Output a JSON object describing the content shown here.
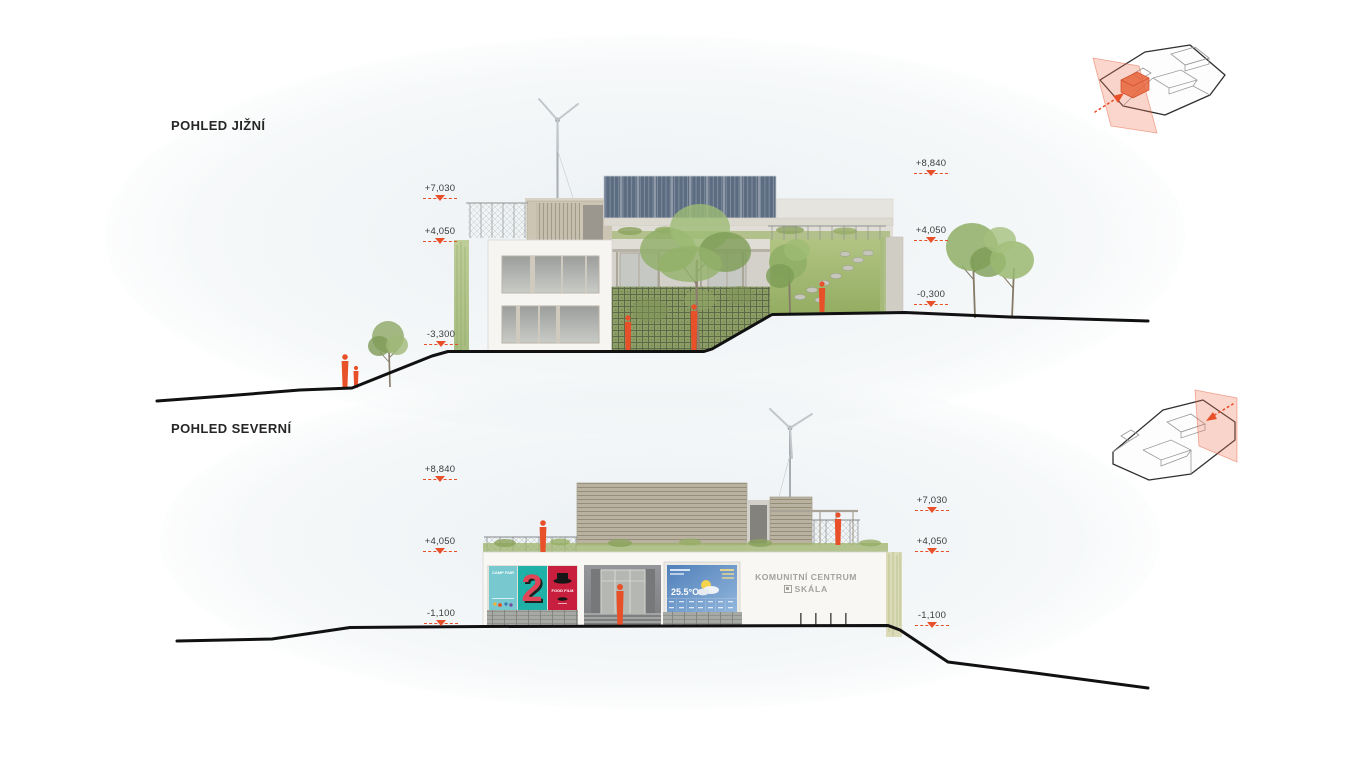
{
  "colors": {
    "accent_orange": "#E8502A",
    "terrain_line": "#111111",
    "title_text": "#262626",
    "marker_text": "#3C3C3C",
    "sign_text": "#A3A39E",
    "solar_panel": "#5D6C80",
    "trellis_green": "#8D9E66"
  },
  "south_elevation": {
    "title": "POHLED JIŽNÍ",
    "markers_left": [
      {
        "label": "+7,030"
      },
      {
        "label": "+4,050"
      },
      {
        "label": "-3,300"
      }
    ],
    "markers_right": [
      {
        "label": "+8,840"
      },
      {
        "label": "+4,050"
      },
      {
        "label": "-0,300"
      }
    ]
  },
  "north_elevation": {
    "title": "POHLED SEVERNÍ",
    "markers_left": [
      {
        "label": "+8,840"
      },
      {
        "label": "+4,050"
      },
      {
        "label": "-1,100"
      }
    ],
    "markers_right": [
      {
        "label": "+7,030"
      },
      {
        "label": "+4,050"
      },
      {
        "label": "-1,100"
      }
    ],
    "sign": {
      "line1": "KOMUNITNÍ CENTRUM",
      "line2": "SKÁLA"
    },
    "posters": [
      {
        "label": "CAMP FAIR"
      },
      {
        "label": "2"
      },
      {
        "label": "FOOD FILM"
      }
    ],
    "info_screen": {
      "temperature": "25.5°C"
    }
  }
}
